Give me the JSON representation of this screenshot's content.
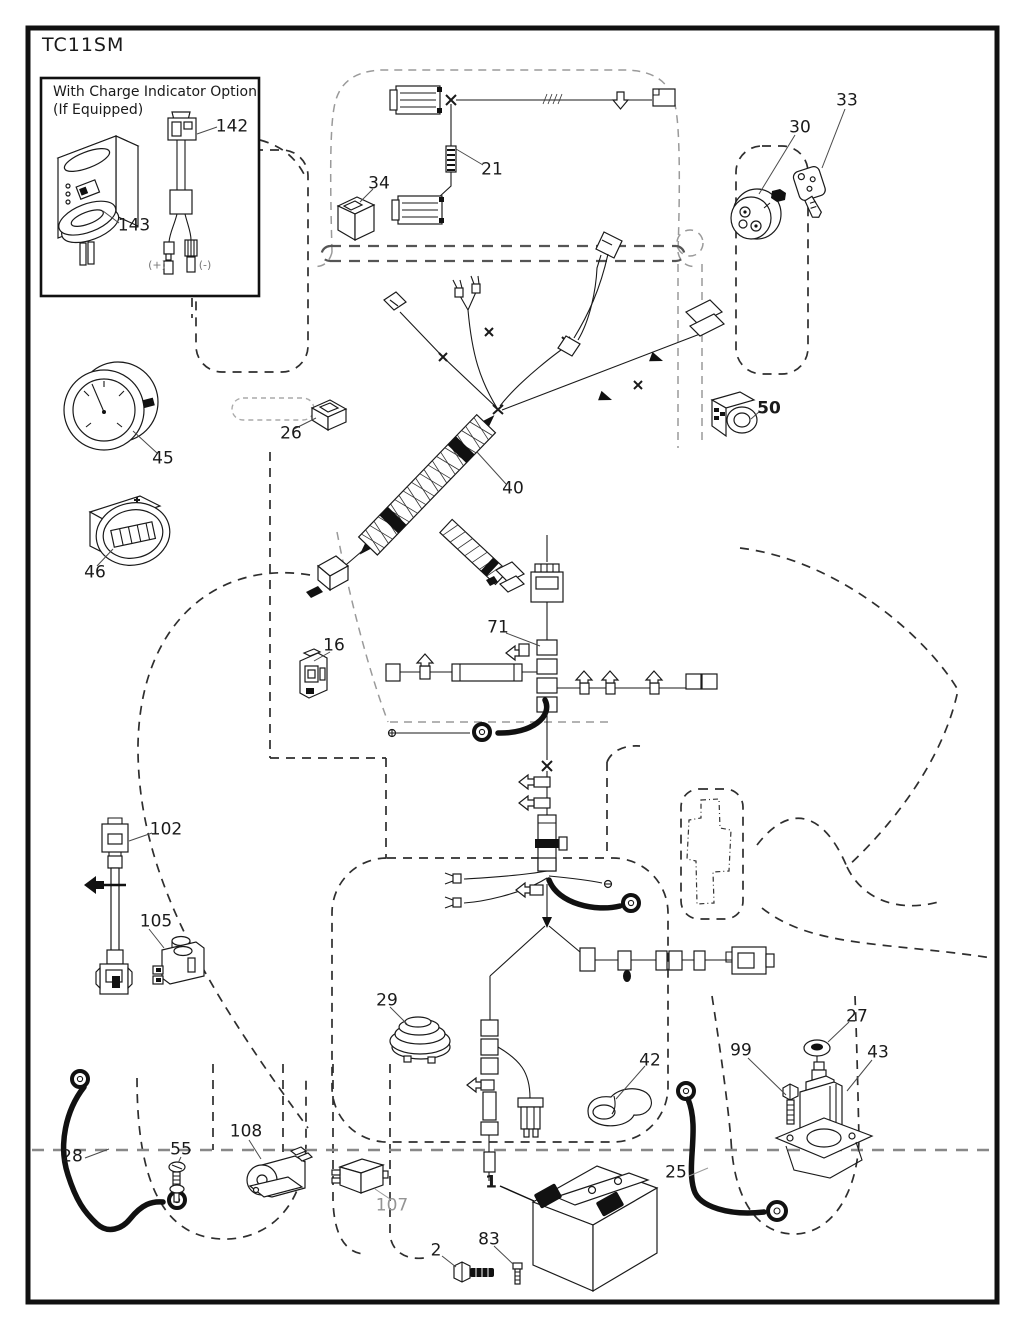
{
  "page": {
    "code": "TC11SM"
  },
  "inset": {
    "title_line1": "With Charge Indicator Option",
    "title_line2": "(If Equipped)",
    "callouts": {
      "p142": "142",
      "p143": "143"
    },
    "polarity": {
      "positive": "(+)",
      "negative": "(-)"
    }
  },
  "callouts": {
    "p1": "1",
    "p2": "2",
    "p16": "16",
    "p21": "21",
    "p25": "25",
    "p26": "26",
    "p27": "27",
    "p28": "28",
    "p29": "29",
    "p30": "30",
    "p33": "33",
    "p34": "34",
    "p40": "40",
    "p42": "42",
    "p43": "43",
    "p45": "45",
    "p46": "46",
    "p50": "50",
    "p55": "55",
    "p71": "71",
    "p83": "83",
    "p99": "99",
    "p102": "102",
    "p105": "105",
    "p107": "107",
    "p108": "108"
  },
  "colors": {
    "ink": "#1a1a1a",
    "dashed_outline": "#2e2e2e",
    "light_outline": "#9a9a9a",
    "muted_label": "#949494"
  }
}
